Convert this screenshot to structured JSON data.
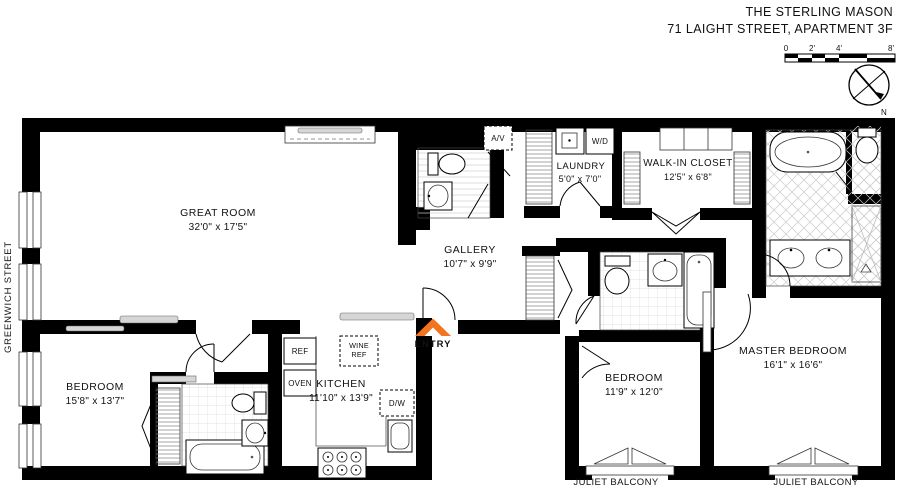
{
  "header": {
    "line1": "THE STERLING MASON",
    "line2": "71 LAIGHT STREET, APARTMENT 3F"
  },
  "scale_bar": {
    "t0": "0",
    "t2": "2'",
    "t4": "4'",
    "t8": "8'"
  },
  "compass": {
    "north": "N"
  },
  "street_label": "GREENWICH STREET",
  "entry": {
    "label": "ENTRY",
    "color": "#F4731F"
  },
  "rooms": {
    "great_room": {
      "name": "GREAT ROOM",
      "dims": "32'0\" x 17'5\""
    },
    "gallery": {
      "name": "GALLERY",
      "dims": "10'7\" x 9'9\""
    },
    "laundry": {
      "name": "LAUNDRY",
      "dims": "5'0\" x 7'0\""
    },
    "walk_in_closet": {
      "name": "WALK-IN CLOSET",
      "dims": "12'5\" x 6'8\""
    },
    "kitchen": {
      "name": "KITCHEN",
      "dims": "11'10\" x 13'9\""
    },
    "bedroom_1": {
      "name": "BEDROOM",
      "dims": "15'8\" x 13'7\""
    },
    "bedroom_2": {
      "name": "BEDROOM",
      "dims": "11'9\" x 12'0\""
    },
    "master_bedroom": {
      "name": "MASTER BEDROOM",
      "dims": "16'1\" x 16'6\""
    },
    "juliet_balcony_1": {
      "name": "JULIET BALCONY"
    },
    "juliet_balcony_2": {
      "name": "JULIET BALCONY"
    }
  },
  "appliances": {
    "av": "A/V",
    "wd": "W/D",
    "ref": "REF",
    "wine_ref_line1": "WINE",
    "wine_ref_line2": "REF",
    "oven": "OVEN",
    "dw": "D/W"
  }
}
